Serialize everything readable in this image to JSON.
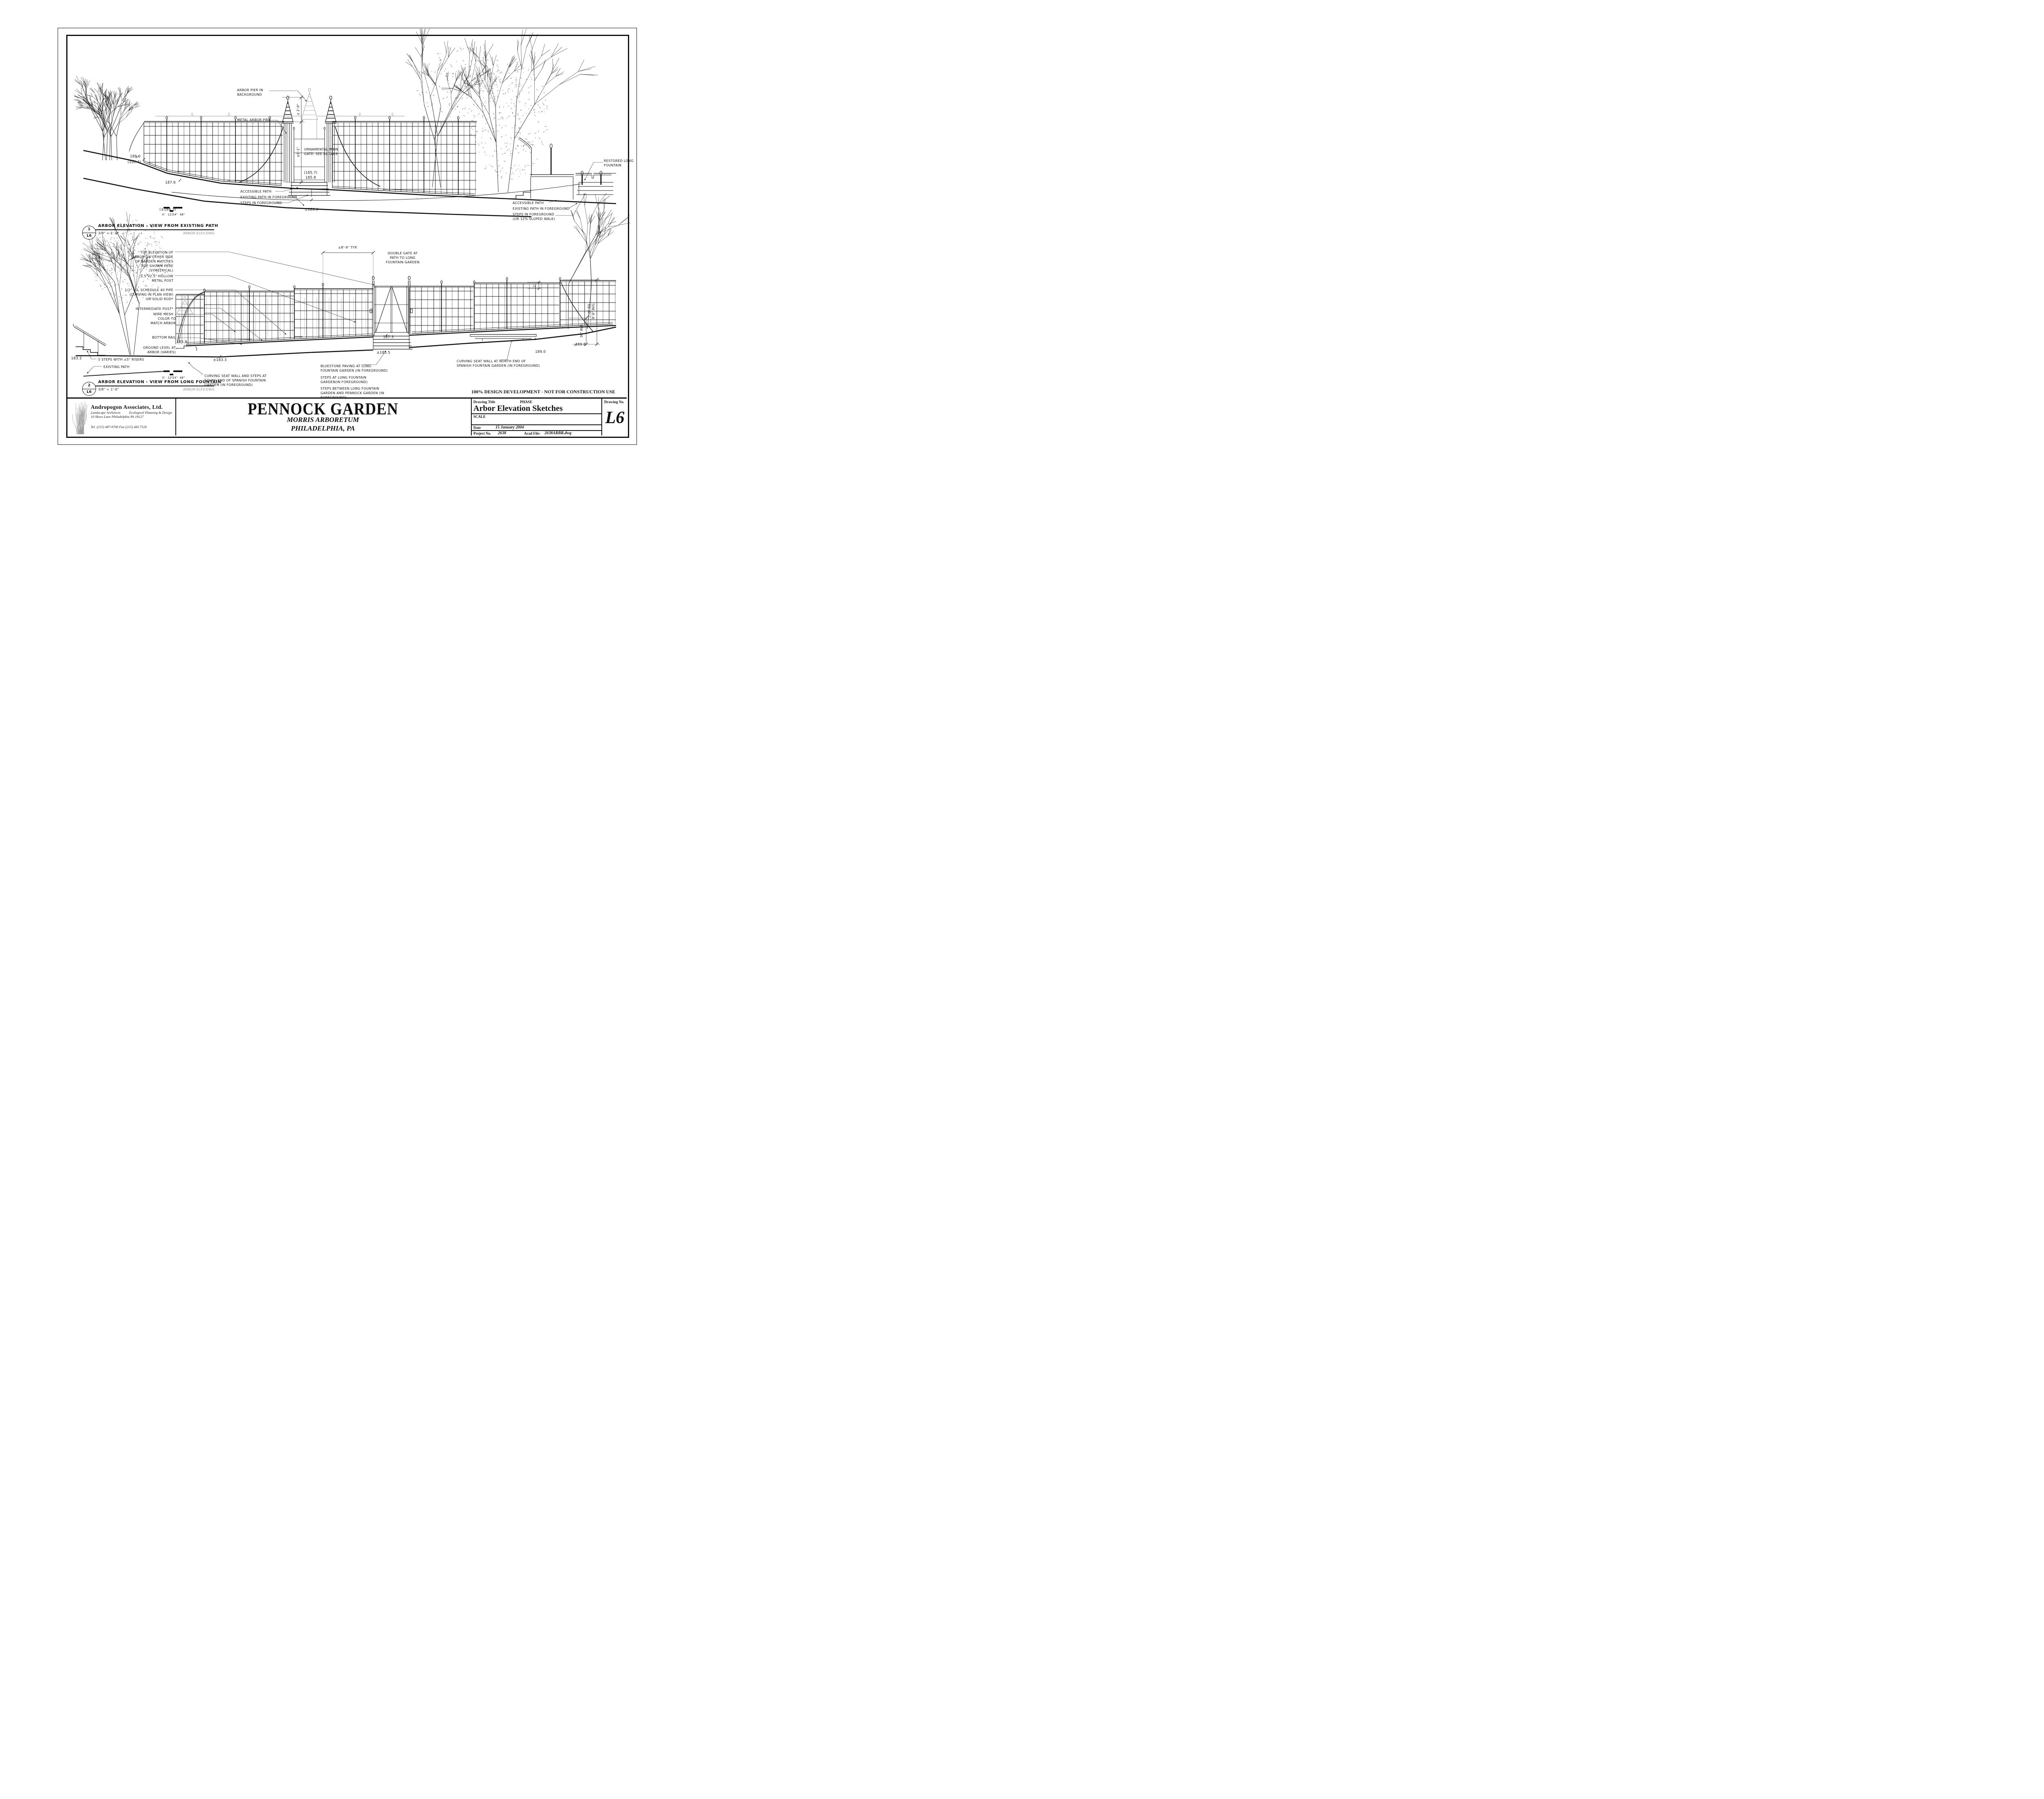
{
  "sheet": {
    "dev_note": "100% DESIGN DEVELOPMENT - NOT FOR CONSTRUCTION USE",
    "project": {
      "name": "PENNOCK GARDEN",
      "facility": "MORRIS ARBORETUM",
      "location": "PHILADELPHIA, PA"
    },
    "firm": {
      "name": "Andropogon Associates, Ltd.",
      "discipline1": "Landscape Architects",
      "discipline2": "Ecological Planning & Design",
      "address": "10 Shurs Lane   Philadelphia PA 19127",
      "phone": "Tel. (215) 487-0700    Fax (215) 483.7520"
    },
    "title_block": {
      "drawing_title_label": "Drawing Title",
      "phase_label": "PHASE",
      "drawing_title": "Arbor Elevation Sketches",
      "scale_label": "SCALE",
      "date_label": "Date",
      "date": "15 January 2004",
      "project_no_label": "Project No.",
      "project_no": "2638",
      "acad_file_label": "Acad File:",
      "acad_file": "2638ARBR.dwg",
      "drawing_no_label": "Drawing No.",
      "drawing_no": "L6"
    }
  },
  "drawing1": {
    "ref_number": "1",
    "ref_sheet": "L6",
    "title": "ARBOR ELEVATION - VIEW FROM EXISTING PATH",
    "scale": "3/8\" = 1'-0\"",
    "file_tag": "ARBOR-ELEV.DWG",
    "scale_bar": [
      "0'",
      "12\"",
      "24\"",
      "48\""
    ],
    "annotations": {
      "arbor_pier_bg": "ARBOR PIER IN\nBACKGROUND",
      "metal_arbor_pier": "METAL ARBOR PIER",
      "ornamental_gate": "ORNAMENTAL MAIN\nGATE: SEE DETAILS",
      "accessible_path": "ACCESSIBLE PATH",
      "existing_path_fg": "EXISTING PATH IN FOREGROUND",
      "steps_fg": "STEPS IN FOREGROUND",
      "restored_fountain": "RESTORED LONG\nFOUNTAIN",
      "accessible_path_r": "ACCESSIBLE PATH",
      "existing_path_fg_r": "EXISTING PATH IN FOREGROUND",
      "steps_fg_r": "STEPS IN FOREGROUND\n(OR 12% SLOPED WALK)"
    },
    "dimensions": {
      "pier_top": "± 2'-0\"",
      "pier_height": "±9'-1\""
    },
    "elevations": {
      "e1": "189.0",
      "e2": "(190.4)",
      "e3": "187.6",
      "e4": "(±184.3)",
      "e5": "(185.7)",
      "e6": "185.8",
      "e7": "±183.3"
    }
  },
  "drawing2": {
    "ref_number": "2",
    "ref_sheet": "L6",
    "title": "ARBOR ELEVATION - VIEW FROM LONG FOUNTAIN",
    "scale": "3/8\" = 1'-0\"",
    "file_tag": "ARBOR-ELEV.DWG",
    "scale_bar": [
      "0'",
      "12\"",
      "24\"",
      "48\""
    ],
    "annotations": {
      "top_elev": "TOP ELEVATION OF\nARBOR ON OTHER SIDE\nOF GARDEN MATCHES\nTOP SHOWN HERE\n(SYMETRICAL)",
      "metal_post": "2.5\"x2.5\" HOLLOW\nMETAL POST",
      "pipe": "1/2\" I.D. SCHEDULE 40 PIPE\n(CURVING IN PLAN VIEW)\nOR SOLID ROD*",
      "intermediate_post": "INTERMEDIATE POST*",
      "wire_mesh": "WIRE MESH -\nCOLOR TO\nMATCH ARBOR",
      "bottom_rail": "BOTTOM RAIL",
      "ground_level": "GROUND LEVEL AT\nARBOR (VARIES)",
      "double_gate": "DOUBLE GATE AT\nPATH TO LONG\nFOUNTAIN GARDEN",
      "steps_risers": "5 STEPS WITH ±5\" RISERS",
      "existing_path": "EXISTING PATH",
      "bluestone": "BLUESTONE PAVING AT LONG\nFOUNTAIN GARDEN (IN FOREGROUND)",
      "steps_lfg": "STEPS AT LONG FOUNTAIN\nGARDEN(IN FOREGROUND)",
      "steps_between": "STEPS BETWEEN LONG FOUNTAIN\nGARDEN AND PENNOCK GARDEN (IN\nFOREGROUND)",
      "seat_wall_s": "CURVING SEAT WALL AND STEPS AT\nSOUTH END OF SPANISH FOUNTAIN\nGARDEN (IN FOREGROUND)",
      "seat_wall_n": "CURVING SEAT WALL AT NORTH END OF\nSPANISH FOUNTAIN GARDEN (IN FOREGROUND)"
    },
    "dimensions": {
      "bay": "±8'-9\" TYP.",
      "height_range": "7'-0\" TO\n8'-6\" AVG.",
      "mesh_height": "36\" AVG.",
      "rail_gap": "1'"
    },
    "elevations": {
      "e1": "183.3",
      "e2": "±183.3",
      "e3": "185.8",
      "e4": "187.3",
      "e5": "±185.5",
      "e6": "189.8",
      "e7": "189.0"
    }
  }
}
